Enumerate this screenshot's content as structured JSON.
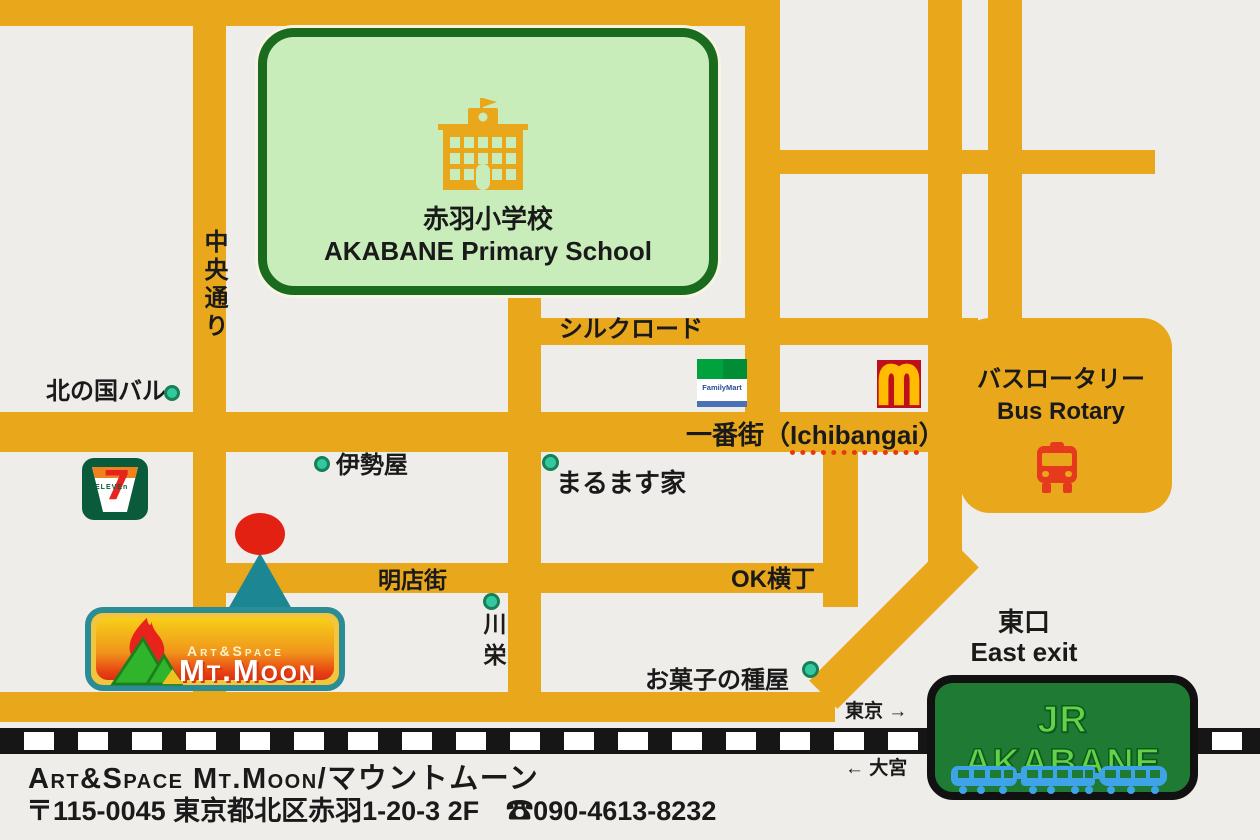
{
  "colors": {
    "bg": "#EFEDEA",
    "road": "#E9A81C",
    "ink": "#1A1A1A",
    "school-fill": "#C9ECBB",
    "school-border": "#1A6B1E",
    "dot-fill": "#33C9A0",
    "dot-border": "#178055",
    "marker-red": "#E22112",
    "marker-teal": "#1C8793",
    "mcd-red": "#BE0F1D",
    "mcd-yellow": "#FFBC00",
    "fm-green": "#00A23E",
    "fm-green-dark": "#008D36",
    "fm-blue": "#2B4B9B",
    "fm-bar": "#4A71B5",
    "seven-green": "#0A5A3C",
    "seven-orange": "#F0821E",
    "seven-red": "#E6231E",
    "bus-red": "#E63A1E",
    "rail-black": "#161616",
    "jr-green": "#1F7B33",
    "jr-text": "#62D348",
    "train-blue": "#3FA3E8",
    "moon-teal": "#2A8C94",
    "moon-gold": "#F3C43E"
  },
  "map": {
    "streets": {
      "chuo_dori": "中央通り",
      "silk_road": "シルクロード",
      "ichibangai_jp": "一番街（",
      "ichibangai_en": "Ichibangai",
      "ichibangai_close": "）",
      "meitengai": "明店街",
      "ok_yokocho": "OK横丁"
    },
    "school": {
      "name_jp": "赤羽小学校",
      "name_en": "AKABANE Primary School"
    },
    "landmarks": {
      "kitanokuni": "北の国バル",
      "iseya": "伊勢屋",
      "marumasuya": "まるます家",
      "kawaei": "川栄",
      "okashi": "お菓子の種屋"
    },
    "brands": {
      "familymart": "FamilyMart",
      "seven_numeral": "7",
      "seven_eleven": "ELEVEn"
    },
    "rotary": {
      "jp": "バスロータリー",
      "en": "Bus Rotary"
    },
    "station": {
      "exit_jp": "東口",
      "exit_en": "East exit",
      "name": "JR AKABANE",
      "to_tokyo": "東京 →",
      "to_omiya": "← 大宮"
    },
    "venue": {
      "brand": "Art&Space",
      "name": "Mt.Moon"
    }
  },
  "footer": {
    "line1": "Art&Space Mt.Moon/マウントムーン",
    "line2": "〒115-0045 東京都北区赤羽1-20-3 2F　☎090-4613-8232"
  }
}
